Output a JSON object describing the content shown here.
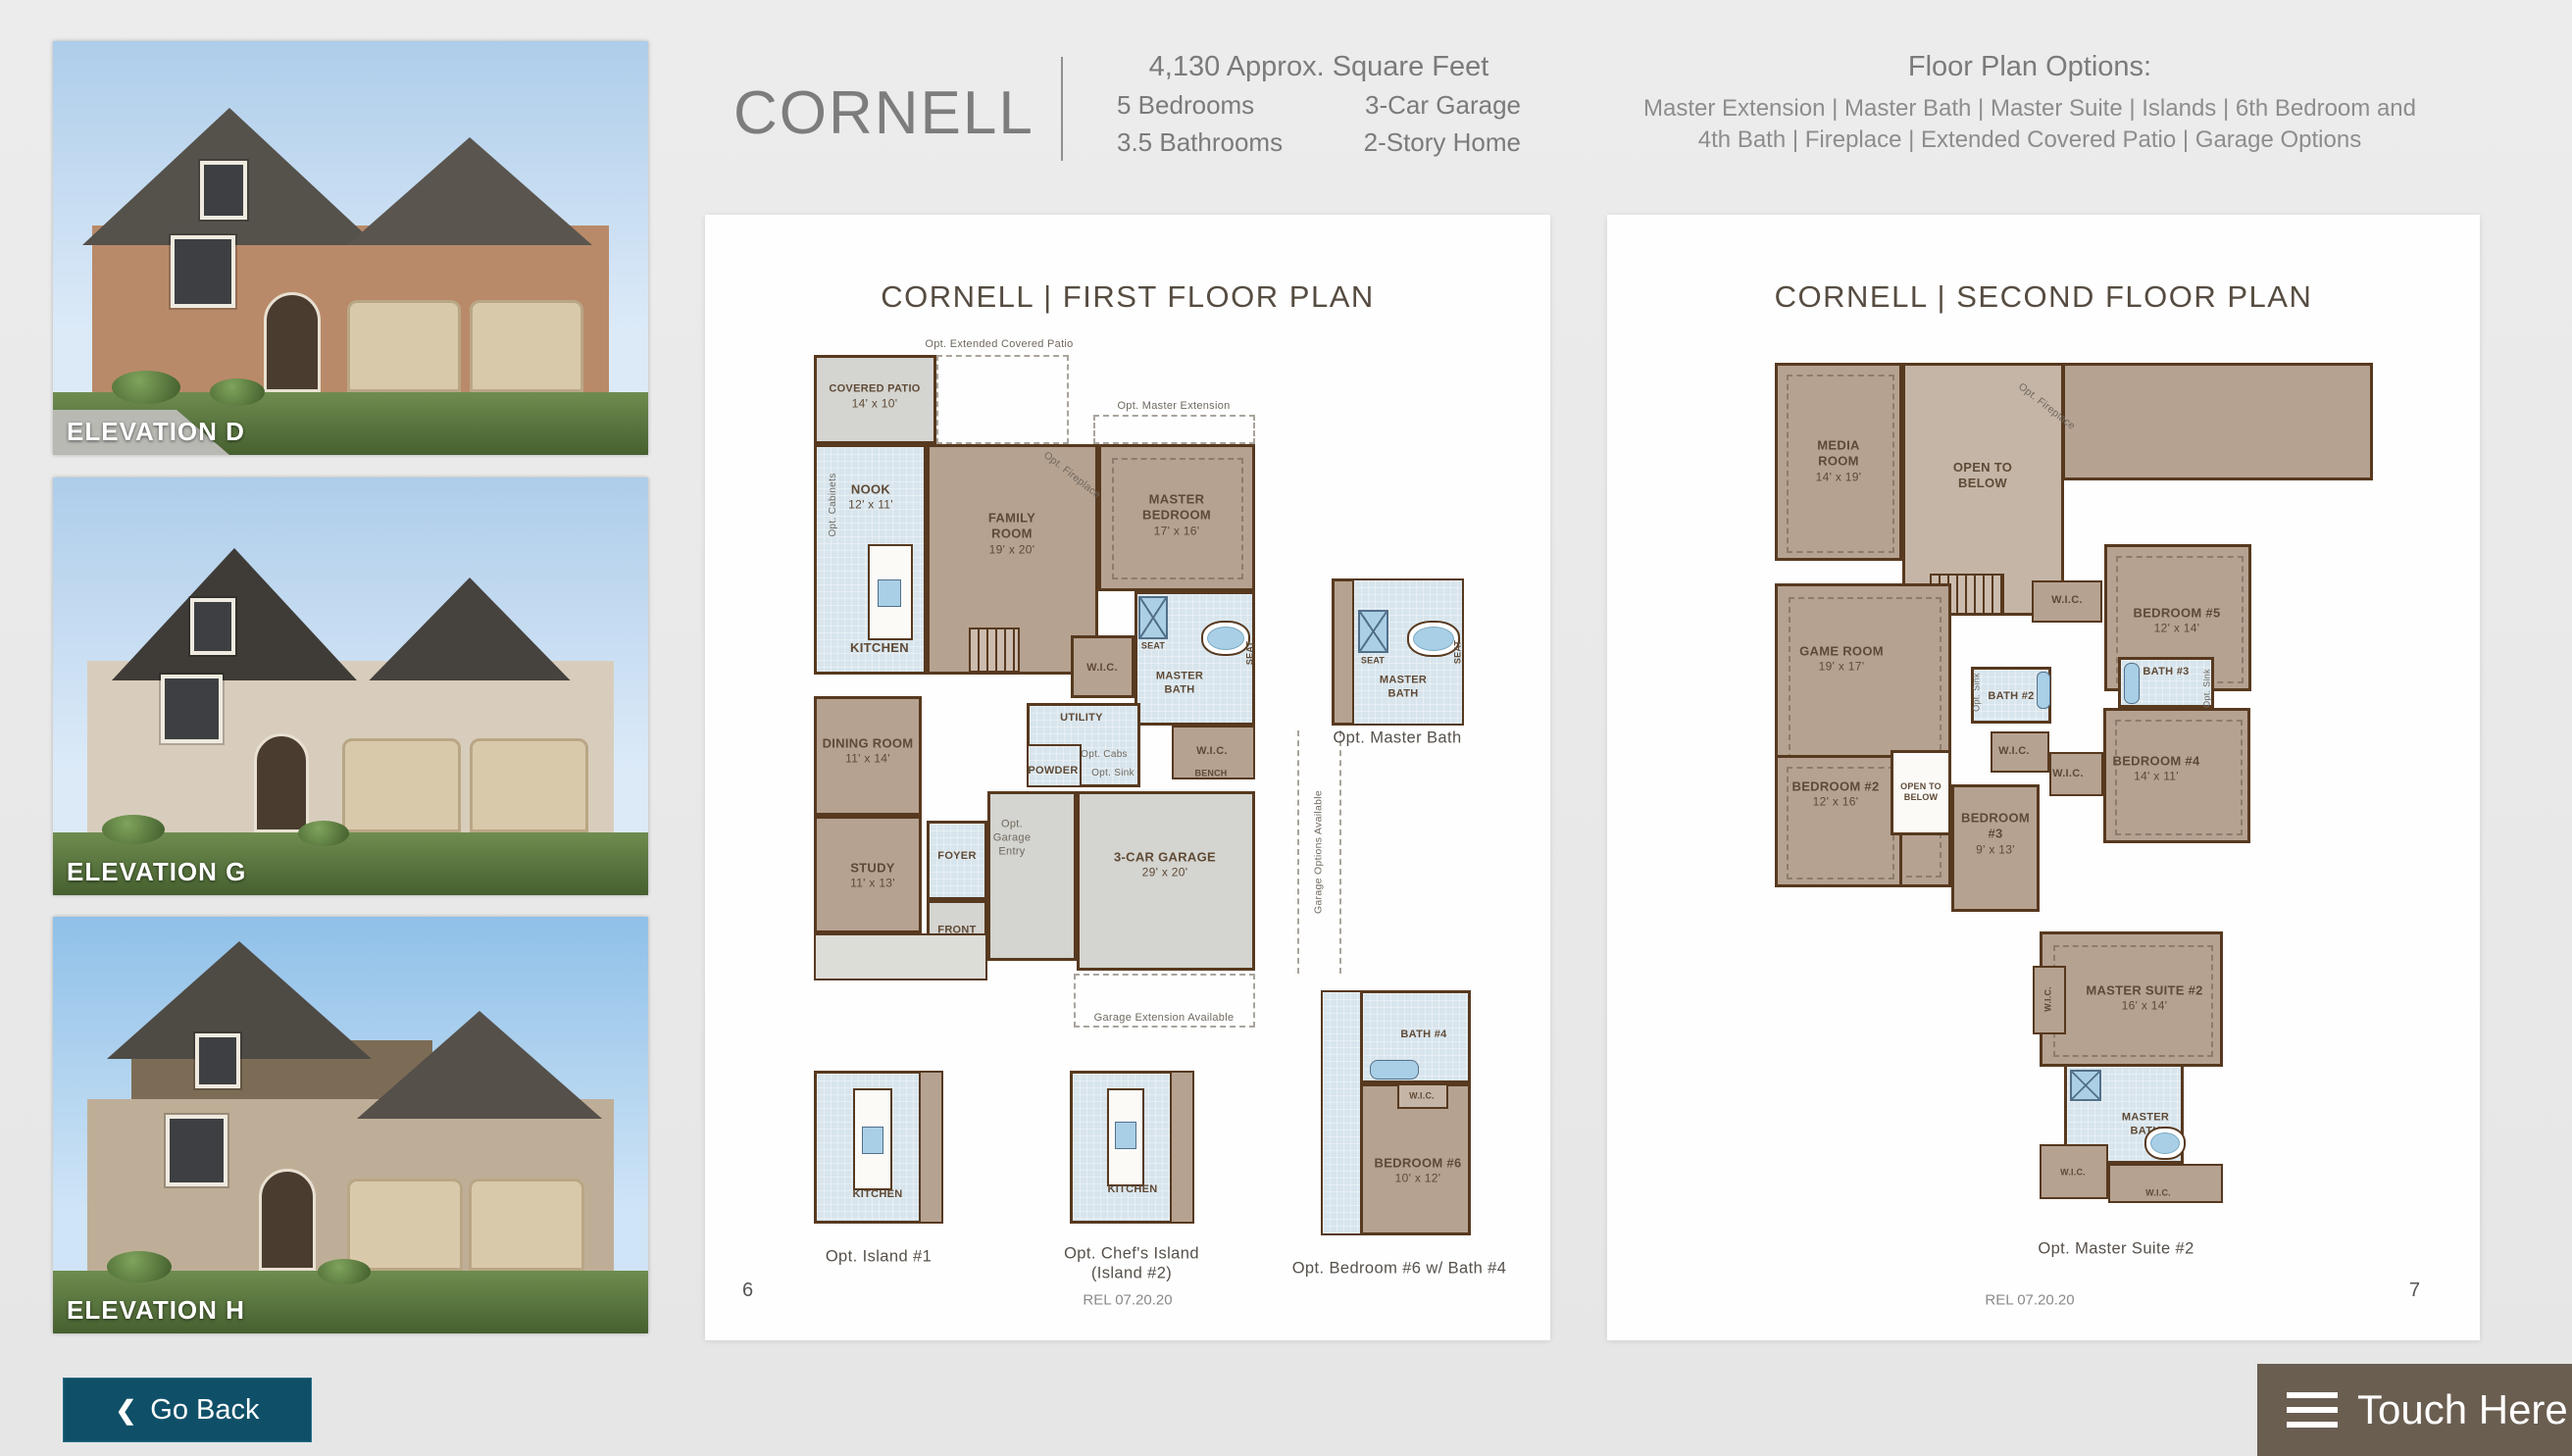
{
  "header": {
    "title": "CORNELL",
    "sqft": "4,130 Approx. Square Feet",
    "spec_rows": [
      {
        "left": "5 Bedrooms",
        "right": "3-Car Garage"
      },
      {
        "left": "3.5 Bathrooms",
        "right": "2-Story Home"
      }
    ],
    "options_title": "Floor Plan Options:",
    "options_line1": "Master Extension | Master Bath | Master Suite | Islands | 6th Bedroom and",
    "options_line2": "4th Bath | Fireplace | Extended Covered Patio | Garage Options"
  },
  "elevations": {
    "d": "ELEVATION D",
    "g": "ELEVATION G",
    "h": "ELEVATION H"
  },
  "go_back": {
    "chevron": "❮",
    "label": "Go Back"
  },
  "touch_here": {
    "label": "Touch Here"
  },
  "colors": {
    "go_back_bg": "#0f5068",
    "touch_here_bg": "#6a5e51",
    "wall": "#57391f",
    "room_tan": "#b6a291",
    "room_blue": "#d8e5ed",
    "room_gray": "#d4d4d0"
  },
  "ff": {
    "title": "CORNELL  |  FIRST FLOOR PLAN",
    "page": "6",
    "rel": "REL 07.20.20",
    "labels": {
      "opt_ext_patio": "Opt. Extended Covered Patio",
      "covered_patio": "COVERED PATIO",
      "covered_patio_dim": "14' x 10'",
      "opt_master_ext": "Opt. Master Extension",
      "nook": "NOOK",
      "nook_dim": "12' x 11'",
      "opt_cabinets": "Opt. Cabinets",
      "family": "FAMILY ROOM",
      "family_dim": "19' x 20'",
      "opt_fireplace": "Opt. Fireplace",
      "master_bedroom": "MASTER BEDROOM",
      "master_bedroom_dim": "17' x 16'",
      "kitchen": "KITCHEN",
      "seat": "SEAT",
      "master_bath": "MASTER BATH",
      "wic": "W.I.C.",
      "utility": "UTILITY",
      "opt_cabs": "Opt. Cabs",
      "opt_sink": "Opt. Sink",
      "powder": "POWDER",
      "bench": "BENCH",
      "dining": "DINING ROOM",
      "dining_dim": "11' x 14'",
      "study": "STUDY",
      "study_dim": "11' x 13'",
      "foyer": "FOYER",
      "opt_garage_entry": "Opt. Garage Entry",
      "garage": "3-CAR GARAGE",
      "garage_dim": "29' x 20'",
      "front_porch": "FRONT PORCH",
      "garage_ext": "Garage Extension Available",
      "garage_opts": "Garage Options Available",
      "opt_master_bath_cap": "Opt. Master Bath",
      "island1_cap": "Opt. Island #1",
      "island2_cap1": "Opt. Chef's Island",
      "island2_cap2": "(Island #2)",
      "bath4": "BATH #4",
      "bedroom6": "BEDROOM #6",
      "bedroom6_dim": "10' x 12'",
      "bedroom6_cap": "Opt. Bedroom #6 w/ Bath #4"
    }
  },
  "sf": {
    "title": "CORNELL  |  SECOND FLOOR PLAN",
    "page": "7",
    "rel": "REL 07.20.20",
    "labels": {
      "media": "MEDIA ROOM",
      "media_dim": "14' x 19'",
      "open_below": "OPEN TO BELOW",
      "opt_fireplace": "Opt. Fireplace",
      "game": "GAME ROOM",
      "game_dim": "19' x 17'",
      "wic": "W.I.C.",
      "bedroom5": "BEDROOM #5",
      "bedroom5_dim": "12' x 14'",
      "bath2": "BATH #2",
      "bath3": "BATH #3",
      "opt_sink": "Opt. Sink",
      "bedroom4": "BEDROOM #4",
      "bedroom4_dim": "14' x 11'",
      "bedroom2": "BEDROOM #2",
      "bedroom2_dim": "12' x 16'",
      "bedroom3": "BEDROOM #3",
      "bedroom3_dim": "9' x 13'",
      "master_suite2": "MASTER SUITE #2",
      "master_suite2_dim": "16' x 14'",
      "master_bath": "MASTER BATH",
      "suite_cap": "Opt. Master Suite #2"
    }
  }
}
